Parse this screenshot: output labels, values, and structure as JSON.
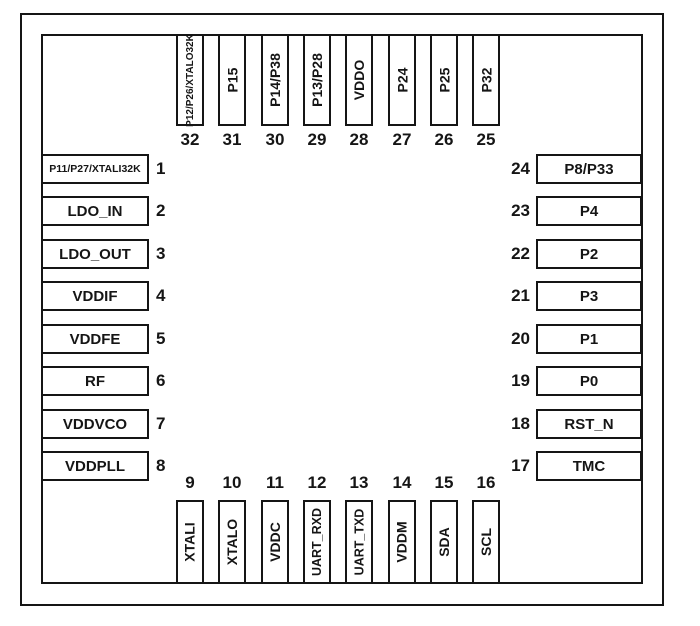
{
  "figure": {
    "type": "ic-pinout-diagram",
    "pin_count": 32,
    "background_color": "#ffffff",
    "line_color": "#151515"
  },
  "pins": {
    "left": [
      {
        "num": "1",
        "label": "P11/P27/XTALI32K"
      },
      {
        "num": "2",
        "label": "LDO_IN"
      },
      {
        "num": "3",
        "label": "LDO_OUT"
      },
      {
        "num": "4",
        "label": "VDDIF"
      },
      {
        "num": "5",
        "label": "VDDFE"
      },
      {
        "num": "6",
        "label": "RF"
      },
      {
        "num": "7",
        "label": "VDDVCO"
      },
      {
        "num": "8",
        "label": "VDDPLL"
      }
    ],
    "top": [
      {
        "num": "32",
        "label": "P12/P26/XTALO32K"
      },
      {
        "num": "31",
        "label": "P15"
      },
      {
        "num": "30",
        "label": "P14/P38"
      },
      {
        "num": "29",
        "label": "P13/P28"
      },
      {
        "num": "28",
        "label": "VDDO"
      },
      {
        "num": "27",
        "label": "P24"
      },
      {
        "num": "26",
        "label": "P25"
      },
      {
        "num": "25",
        "label": "P32"
      }
    ],
    "right": [
      {
        "num": "24",
        "label": "P8/P33"
      },
      {
        "num": "23",
        "label": "P4"
      },
      {
        "num": "22",
        "label": "P2"
      },
      {
        "num": "21",
        "label": "P3"
      },
      {
        "num": "20",
        "label": "P1"
      },
      {
        "num": "19",
        "label": "P0"
      },
      {
        "num": "18",
        "label": "RST_N"
      },
      {
        "num": "17",
        "label": "TMC"
      }
    ],
    "bottom": [
      {
        "num": "9",
        "label": "XTALI"
      },
      {
        "num": "10",
        "label": "XTALO"
      },
      {
        "num": "11",
        "label": "VDDC"
      },
      {
        "num": "12",
        "label": "UART_RXD"
      },
      {
        "num": "13",
        "label": "UART_TXD"
      },
      {
        "num": "14",
        "label": "VDDM"
      },
      {
        "num": "15",
        "label": "SDA"
      },
      {
        "num": "16",
        "label": "SCL"
      }
    ]
  }
}
